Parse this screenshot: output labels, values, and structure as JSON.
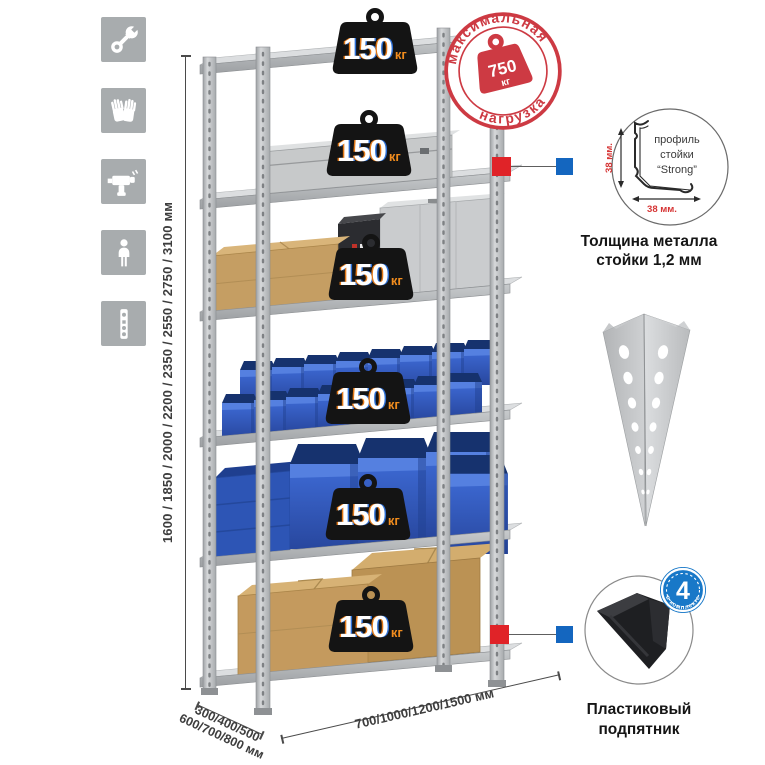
{
  "canvas": {
    "width": 765,
    "height": 765,
    "background": "#ffffff"
  },
  "side_icons": {
    "items": [
      {
        "name": "wrench-icon"
      },
      {
        "name": "gloves-icon"
      },
      {
        "name": "drill-icon"
      },
      {
        "name": "person-icon"
      },
      {
        "name": "rack-post-icon"
      }
    ]
  },
  "rack": {
    "shelf_count": 6
  },
  "badge": {
    "value": "150",
    "unit": "кг"
  },
  "stamp": {
    "arc_top": "максимальная",
    "arc_bottom": "нагрузка",
    "value": "750",
    "unit": "кг"
  },
  "dimensions": {
    "height": "1600 / 1850 / 2000 / 2200 / 2350 / 2550 / 2750 / 3100 мм",
    "depth_line1": "300/400/500",
    "depth_line2": "600/700/800 мм",
    "width": "700/1000/1200/1500 мм"
  },
  "profile_callout": {
    "label_line1": "профиль",
    "label_line2": "стойки",
    "label_line3": "“Strong”",
    "dim_vertical": "38 мм.",
    "dim_horizontal": "38 мм.",
    "caption_line1": "Толщина металла",
    "caption_line2": "стойки 1,2 мм"
  },
  "foot_callout": {
    "badge_value": "4",
    "badge_arc_text": "в комплекте",
    "caption_line1": "Пластиковый",
    "caption_line2": "подпятник"
  },
  "colors": {
    "stamp_red": "#cd3a43",
    "marker_red": "#e02328",
    "marker_blue": "#1466bf",
    "bin_blue": "#3e6bd6",
    "icon_gray": "#a8acae",
    "kg_orange": "#f08c1e",
    "cardboard": "#c59e63",
    "metal": "#c6c9cb"
  }
}
